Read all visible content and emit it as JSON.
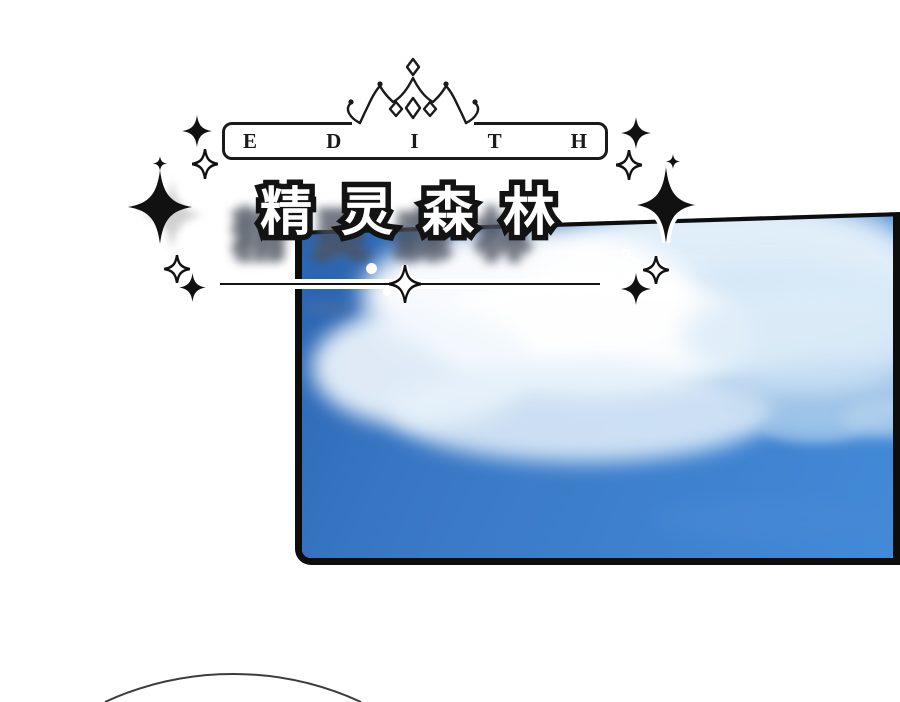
{
  "header": {
    "crown_icon": "crown-line-art",
    "logo_text": "EDITH",
    "logo_letters": [
      "E",
      "D",
      "I",
      "T",
      "H"
    ]
  },
  "title": {
    "text": "精灵森林"
  },
  "decor": {
    "sparkle_filled_icon": "✦",
    "sparkle_outlined_icon": "✧",
    "divider_diamond_icon": "✧"
  },
  "panel": {
    "colors": {
      "ink": "#111111",
      "sky_deep": "#2b65b2",
      "sky_mid": "#3a7ac7",
      "sky_light": "#428ad8",
      "cloud_white": "#ffffff",
      "cloud_tint": "#cfe3f5",
      "haze_light": "#e8f3fb"
    }
  }
}
